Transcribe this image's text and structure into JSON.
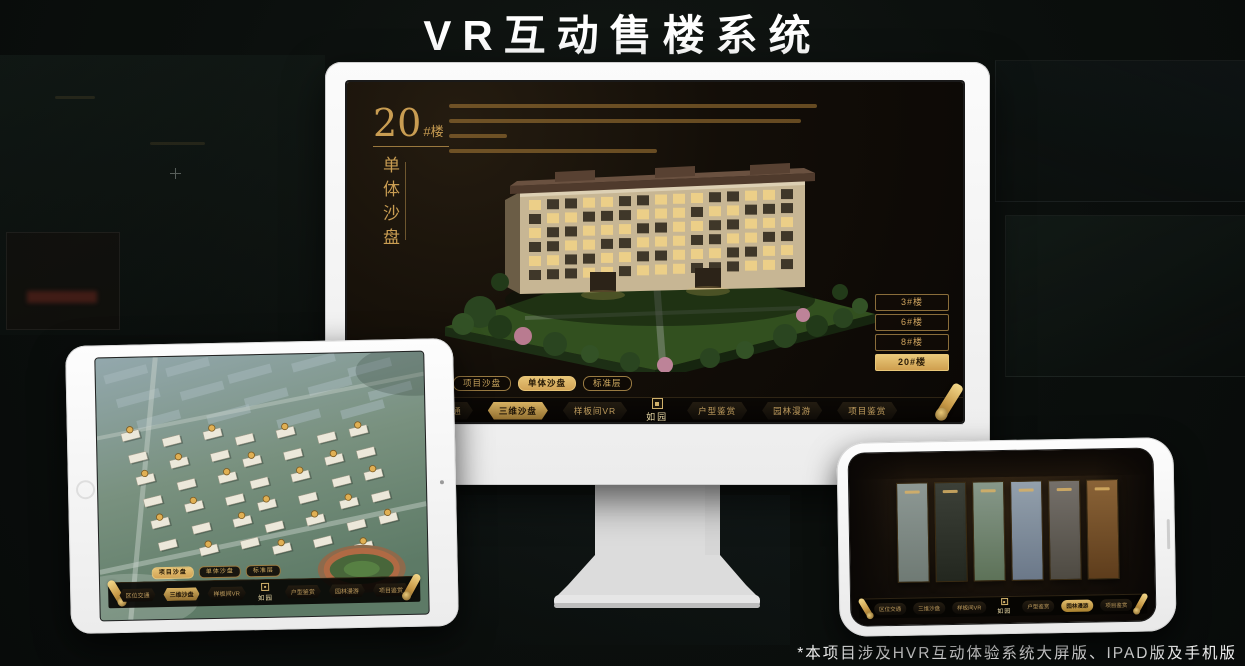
{
  "page": {
    "title": "VR互动售楼系统",
    "footnote": "*本项目涉及HVR互动体验系统大屏版、IPAD版及手机版"
  },
  "brand": {
    "logo_text": "如园",
    "gold": "#cfa45f"
  },
  "nav_shared": {
    "left": [
      "区位交通",
      "三维沙盘",
      "样板间VR"
    ],
    "right": [
      "户型鉴赏",
      "园林漫游",
      "项目鉴赏"
    ]
  },
  "monitor": {
    "headline_number": "20",
    "headline_suffix": "#楼",
    "headline_subtitle": "单体沙盘",
    "building_buttons": [
      "3#楼",
      "6#楼",
      "8#楼",
      "20#楼"
    ],
    "active_building": "20#楼",
    "sub_tabs": [
      "项目沙盘",
      "单体沙盘",
      "标准层"
    ],
    "active_sub_tab": "单体沙盘",
    "active_nav": "三维沙盘"
  },
  "tablet": {
    "sub_tabs": [
      "项目沙盘",
      "单体沙盘",
      "标准层"
    ],
    "active_sub_tab": "项目沙盘",
    "active_nav": "三维沙盘"
  },
  "phone": {
    "active_nav": "园林漫游"
  }
}
